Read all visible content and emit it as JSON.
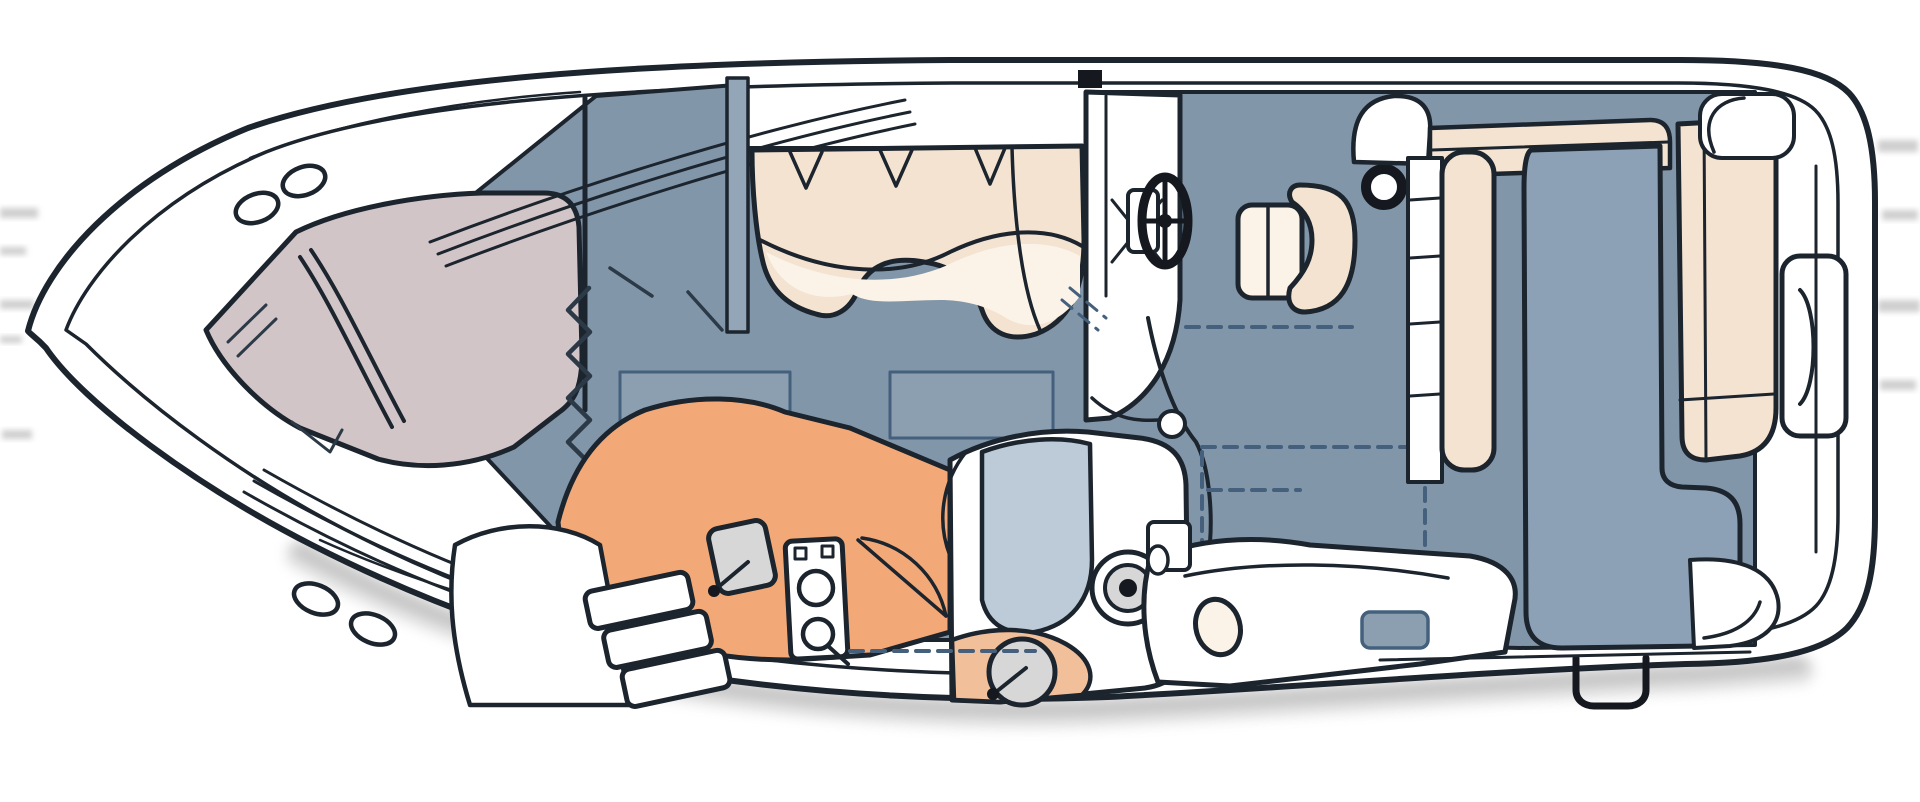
{
  "meta": {
    "title": "Overhead interior floor plan of a motor yacht",
    "view": "top-down line drawing, bow at left, stern at right"
  },
  "colors": {
    "outline": "#1c242e",
    "line2": "#2c3a48",
    "hull": "#ffffff",
    "floor": "#8296a9",
    "hatch": "#8b9fb1",
    "pad": "#8ca1b5",
    "vberth": "#d2c5c7",
    "cream": "#f3e3d0",
    "cream_light": "#fbf3e7",
    "galley": "#f3a977",
    "salmon": "#f2bf9b",
    "shower": "#bccbd7",
    "metal": "#d7d7d7",
    "dark": "#15191f",
    "dash": "#44607c",
    "strip": "#93a6b7",
    "shadow": "#8a8a8a",
    "artifact": "#cfcfcf"
  },
  "labels": {
    "hull": "Boat hull outline",
    "shadow": "Drop shadow under hull",
    "bow_deck": "Bow foredeck",
    "deck_hatch": "Oval deck hatch",
    "rails": "Foredeck rail lines",
    "v_berth": "Forward V-berth cabin",
    "privacy_door": "Accordion privacy door (zigzag symbol)",
    "salon": "Salon floor",
    "locker_lines": "Salon locker detail lines",
    "floor_hatch": "Salon floor hatch",
    "dinette": "Dinette settee",
    "walkthrough": "Windshield walk-through strip",
    "galley": "Galley counter",
    "galley_sink": "Galley sink with faucet",
    "stove": "Two-burner stove",
    "door_swing": "Door swing arc",
    "steps": "Companionway steps",
    "head": "Head compartment",
    "shower_pan": "Shower pan",
    "toilet": "Toilet",
    "head_sink": "Head sink with faucet",
    "helm": "Helm console",
    "vent": "Console vent",
    "wheel": "Steering wheel",
    "helm_seat": "Helm seat",
    "cup_holder": "Cup holder ring",
    "cockpit": "Cockpit floor",
    "cockpit_sink": "Cockpit wet-bar sink",
    "bench": "Cockpit bench seating",
    "seatback_left": "Sun pad left backrest",
    "seatback_right": "Sun pad aft backrest",
    "sunpad": "Aft sun pad / berth cushion",
    "mid_berth": "Mid-cabin berth",
    "berth_pillow": "Mid-cabin pillow",
    "berth_hatch": "Mid-cabin hatch",
    "grab_handle": "Transom grab handle",
    "transom": "Transom and swim platform details",
    "dashed_overhead": "Dashed overhead structure lines"
  }
}
